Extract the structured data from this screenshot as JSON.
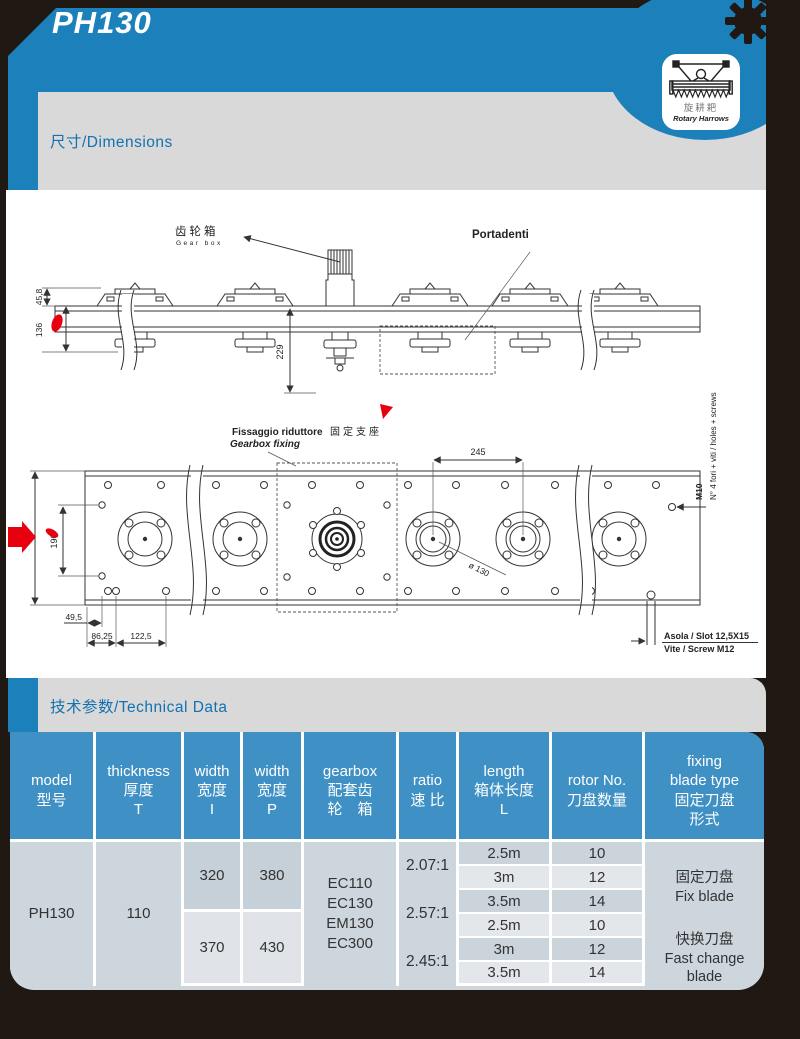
{
  "page": {
    "title": "PH130",
    "badge": {
      "cn": "旋耕耙",
      "en": "Rotary Harrows"
    },
    "section_dimensions": "尺寸/Dimensions",
    "section_technical": "技术参数/Technical Data"
  },
  "colors": {
    "header_blue": "#1c81ba",
    "table_header_blue": "#3f90c4",
    "band_gray": "#d9d9d9",
    "accent_red": "#e8000e"
  },
  "drawing": {
    "gearbox_label_cn": "齿轮箱",
    "gearbox_label_en": "Gear box",
    "portadenti_label": "Portadenti",
    "dim_45_8": "45,8",
    "dim_136": "136",
    "dim_229": "229",
    "fixing_label_it": "Fissaggio riduttore",
    "fixing_label_en": "Gearbox fixing",
    "fixing_label_cn": "固定支座",
    "dim_245": "245",
    "dim_dia_130": "ø 130",
    "dim_190": "190",
    "dim_49_5": "49,5",
    "dim_86_25": "86,25",
    "dim_122_5": "122,5",
    "label_m10": "M10",
    "label_holes": "N° 4 fori + viti / holes + screws",
    "label_slot": "Asola / Slot 12,5X15",
    "label_screw": "Vite / Screw M12"
  },
  "table": {
    "headers": [
      "model\n型号",
      "thickness\n厚度\nT",
      "width\n宽度\nI",
      "width\n宽度\nP",
      "gearbox\n配套齿\n轮　箱",
      "ratio\n速 比",
      "length\n箱体长度\nL",
      "rotor No.\n刀盘数量",
      "fixing\nblade type\n固定刀盘\n形式"
    ],
    "model": "PH130",
    "thickness": "110",
    "width_i": [
      "320",
      "370"
    ],
    "width_p": [
      "380",
      "430"
    ],
    "gearbox": "EC110\nEC130\nEM130\nEC300",
    "ratios": [
      "2.07:1",
      "2.57:1",
      "2.45:1"
    ],
    "lengths": [
      "2.5m",
      "3m",
      "3.5m",
      "2.5m",
      "3m",
      "3.5m"
    ],
    "rotors": [
      "10",
      "12",
      "14",
      "10",
      "12",
      "14"
    ],
    "blade_fix": "固定刀盘\nFix blade",
    "blade_fast": "快换刀盘\nFast change\nblade"
  }
}
